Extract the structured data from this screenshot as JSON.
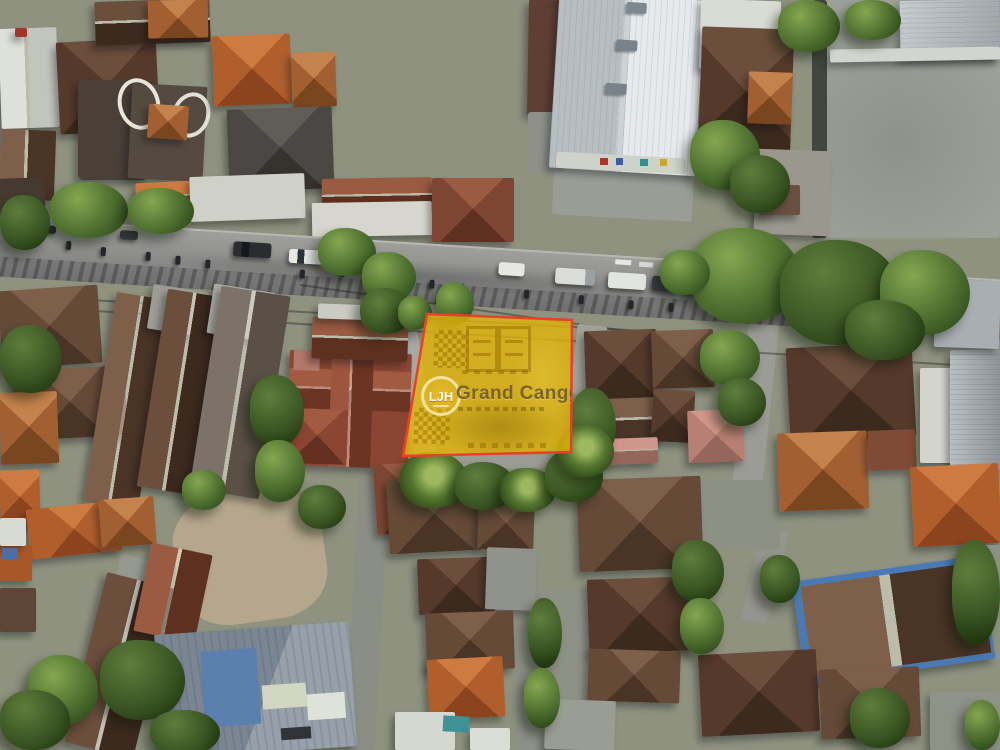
{
  "plot": {
    "logo_text": "LJH",
    "brand_text": "Grand Canggu",
    "polygon_points": "427,314 572,320 571,452 403,456",
    "fill_color": "#e2b407",
    "border_color": "#e8402a"
  }
}
